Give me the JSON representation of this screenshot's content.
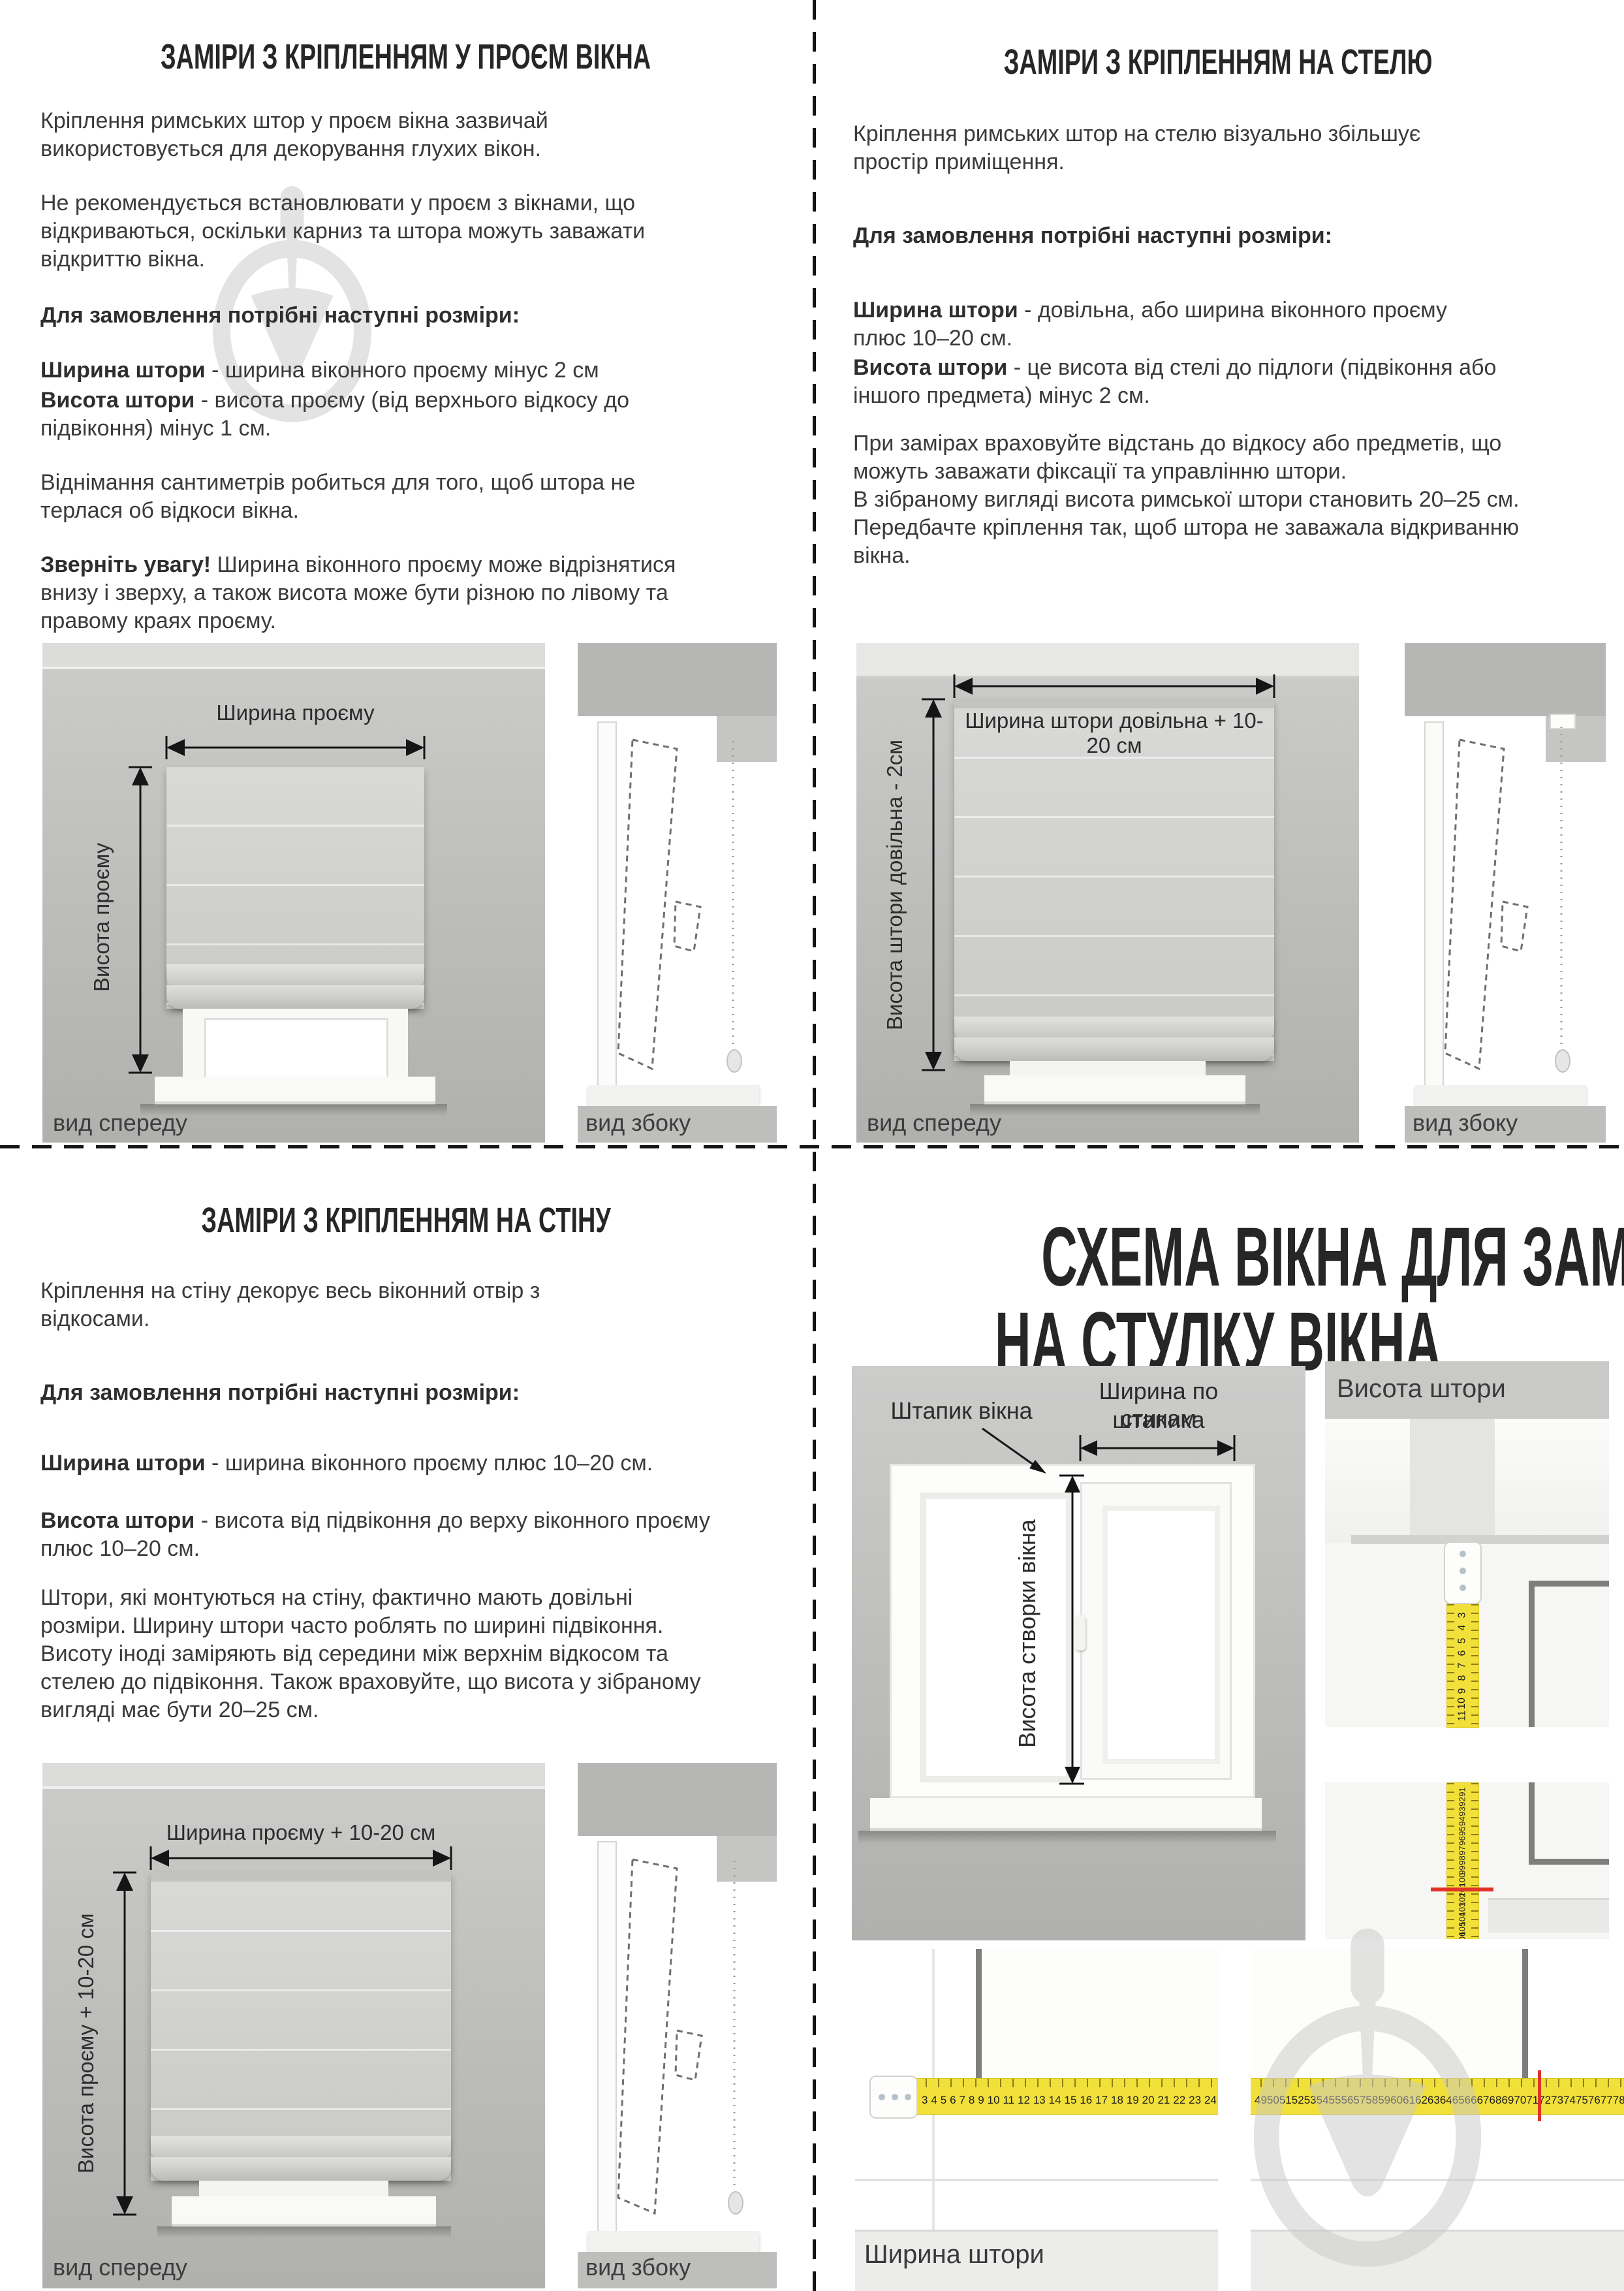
{
  "q1": {
    "title": "ЗАМІРИ З КРІПЛЕННЯМ У ПРОЄМ ВІКНА",
    "p1": "Кріплення римських штор у проєм вікна зазвичай використовується для декорування глухих вікон.",
    "p2": "Не рекомендується встановлювати у проєм з вікнами, що відкриваються, оскільки карниз та штора можуть заважати відкриттю вікна.",
    "order_heading": "Для замовлення потрібні наступні розміри:",
    "def1_b": "Ширина штори",
    "def1_t": " - ширина віконного проєму мінус 2 см",
    "def2_b": "Висота штори",
    "def2_t": " - висота проєму (від верхнього відкосу до підвіконня) мінус 1 см.",
    "p5": "Віднімання сантиметрів робиться для того, щоб штора не терлася об відкоси вікна.",
    "note_b": "Зверніть увагу!",
    "note_t": " Ширина віконного проєму може відрізнятися внизу і зверху, а також висота може бути різною по лівому та правому краях проєму.",
    "fig": {
      "width_label": "Ширина проєму",
      "height_label": "Висота проєму",
      "front_caption": "вид спереду",
      "side_caption": "вид збоку"
    }
  },
  "q2": {
    "title": "ЗАМІРИ З КРІПЛЕННЯМ НА СТЕЛЮ",
    "p1": "Кріплення римських штор на стелю візуально збільшує простір приміщення.",
    "order_heading": "Для замовлення потрібні наступні розміри:",
    "def1_b": "Ширина штори",
    "def1_t": " - довільна, або ширина віконного проєму плюс 10–20 см.",
    "def2_b": "Висота штори",
    "def2_t": " - це висота від стелі до підлоги (підвіконня або іншого предмета) мінус 2 см.",
    "p4a": "При замірах враховуйте відстань до відкосу або предметів, що можуть заважати фіксації та управлінню штори.",
    "p4b": "В зібраному вигляді висота римської штори становить 20–25 см. Передбачте кріплення так, щоб штора не заважала відкриванню вікна.",
    "fig": {
      "width_label": "Ширина штори довільна + 10-20 см",
      "height_label": "Висота штори довільна - 2см",
      "front_caption": "вид спереду",
      "side_caption": "вид збоку"
    }
  },
  "q3": {
    "title": "ЗАМІРИ З КРІПЛЕННЯМ НА СТІНУ",
    "p1": "Кріплення на стіну декорує весь віконний отвір з відкосами.",
    "order_heading": "Для замовлення потрібні наступні розміри:",
    "def1_b": "Ширина штори",
    "def1_t": " - ширина віконного проєму плюс 10–20 см.",
    "def2_b": "Висота штори",
    "def2_t": " - висота від підвіконня до верху віконного проєму плюс 10–20 см.",
    "p4": "Штори, які монтуються на стіну, фактично мають довільні розміри. Ширину штори часто роблять по ширині підвіконня. Висоту іноді заміряють від середини між верхнім відкосом та стелею до підвіконня. Також враховуйте, що висота у зібраному вигляді має бути 20–25 см.",
    "fig": {
      "width_label": "Ширина проєму + 10-20 см",
      "height_label": "Висота проєму + 10-20 см",
      "front_caption": "вид спереду",
      "side_caption": "вид збоку"
    }
  },
  "q4": {
    "title_line1": "СХЕМА ВІКНА ДЛЯ ЗАМІРІВ",
    "title_line2": "НА СТУЛКУ ВІКНА",
    "diagram": {
      "bead_label": "Штапик вікна",
      "width_label_line1": "Ширина по стикам",
      "width_label_line2": "штапика",
      "sash_height_label": "Висота створки вікна"
    },
    "height_photo": {
      "caption": "Висота штори",
      "tape_top_numbers": [
        3,
        4,
        5,
        6,
        7,
        8,
        9,
        10,
        11
      ],
      "tape_bottom_numbers": [
        91,
        92,
        93,
        94,
        95,
        96,
        97,
        98,
        99,
        100,
        101,
        102,
        103,
        104,
        105,
        106,
        107,
        108,
        109,
        110
      ],
      "red_mark_value": 104
    },
    "width_photo": {
      "caption": "Ширина штори",
      "tape_left_numbers": [
        3,
        4,
        5,
        6,
        7,
        8,
        9,
        10,
        11,
        12,
        13,
        14,
        15,
        16,
        17,
        18,
        19,
        20,
        21,
        22,
        23,
        24
      ],
      "tape_right_numbers": [
        49,
        50,
        51,
        52,
        53,
        54,
        55,
        56,
        57,
        58,
        59,
        60,
        61,
        62,
        63,
        64,
        65,
        66,
        67,
        68,
        69,
        70,
        71,
        72,
        73,
        74,
        75,
        76,
        77,
        78,
        79,
        80
      ],
      "red_mark_value": 73
    },
    "colors": {
      "tape_yellow": "#f2e03a",
      "red_mark": "#e03227",
      "watermark_gray": "#c9c9c9"
    }
  }
}
